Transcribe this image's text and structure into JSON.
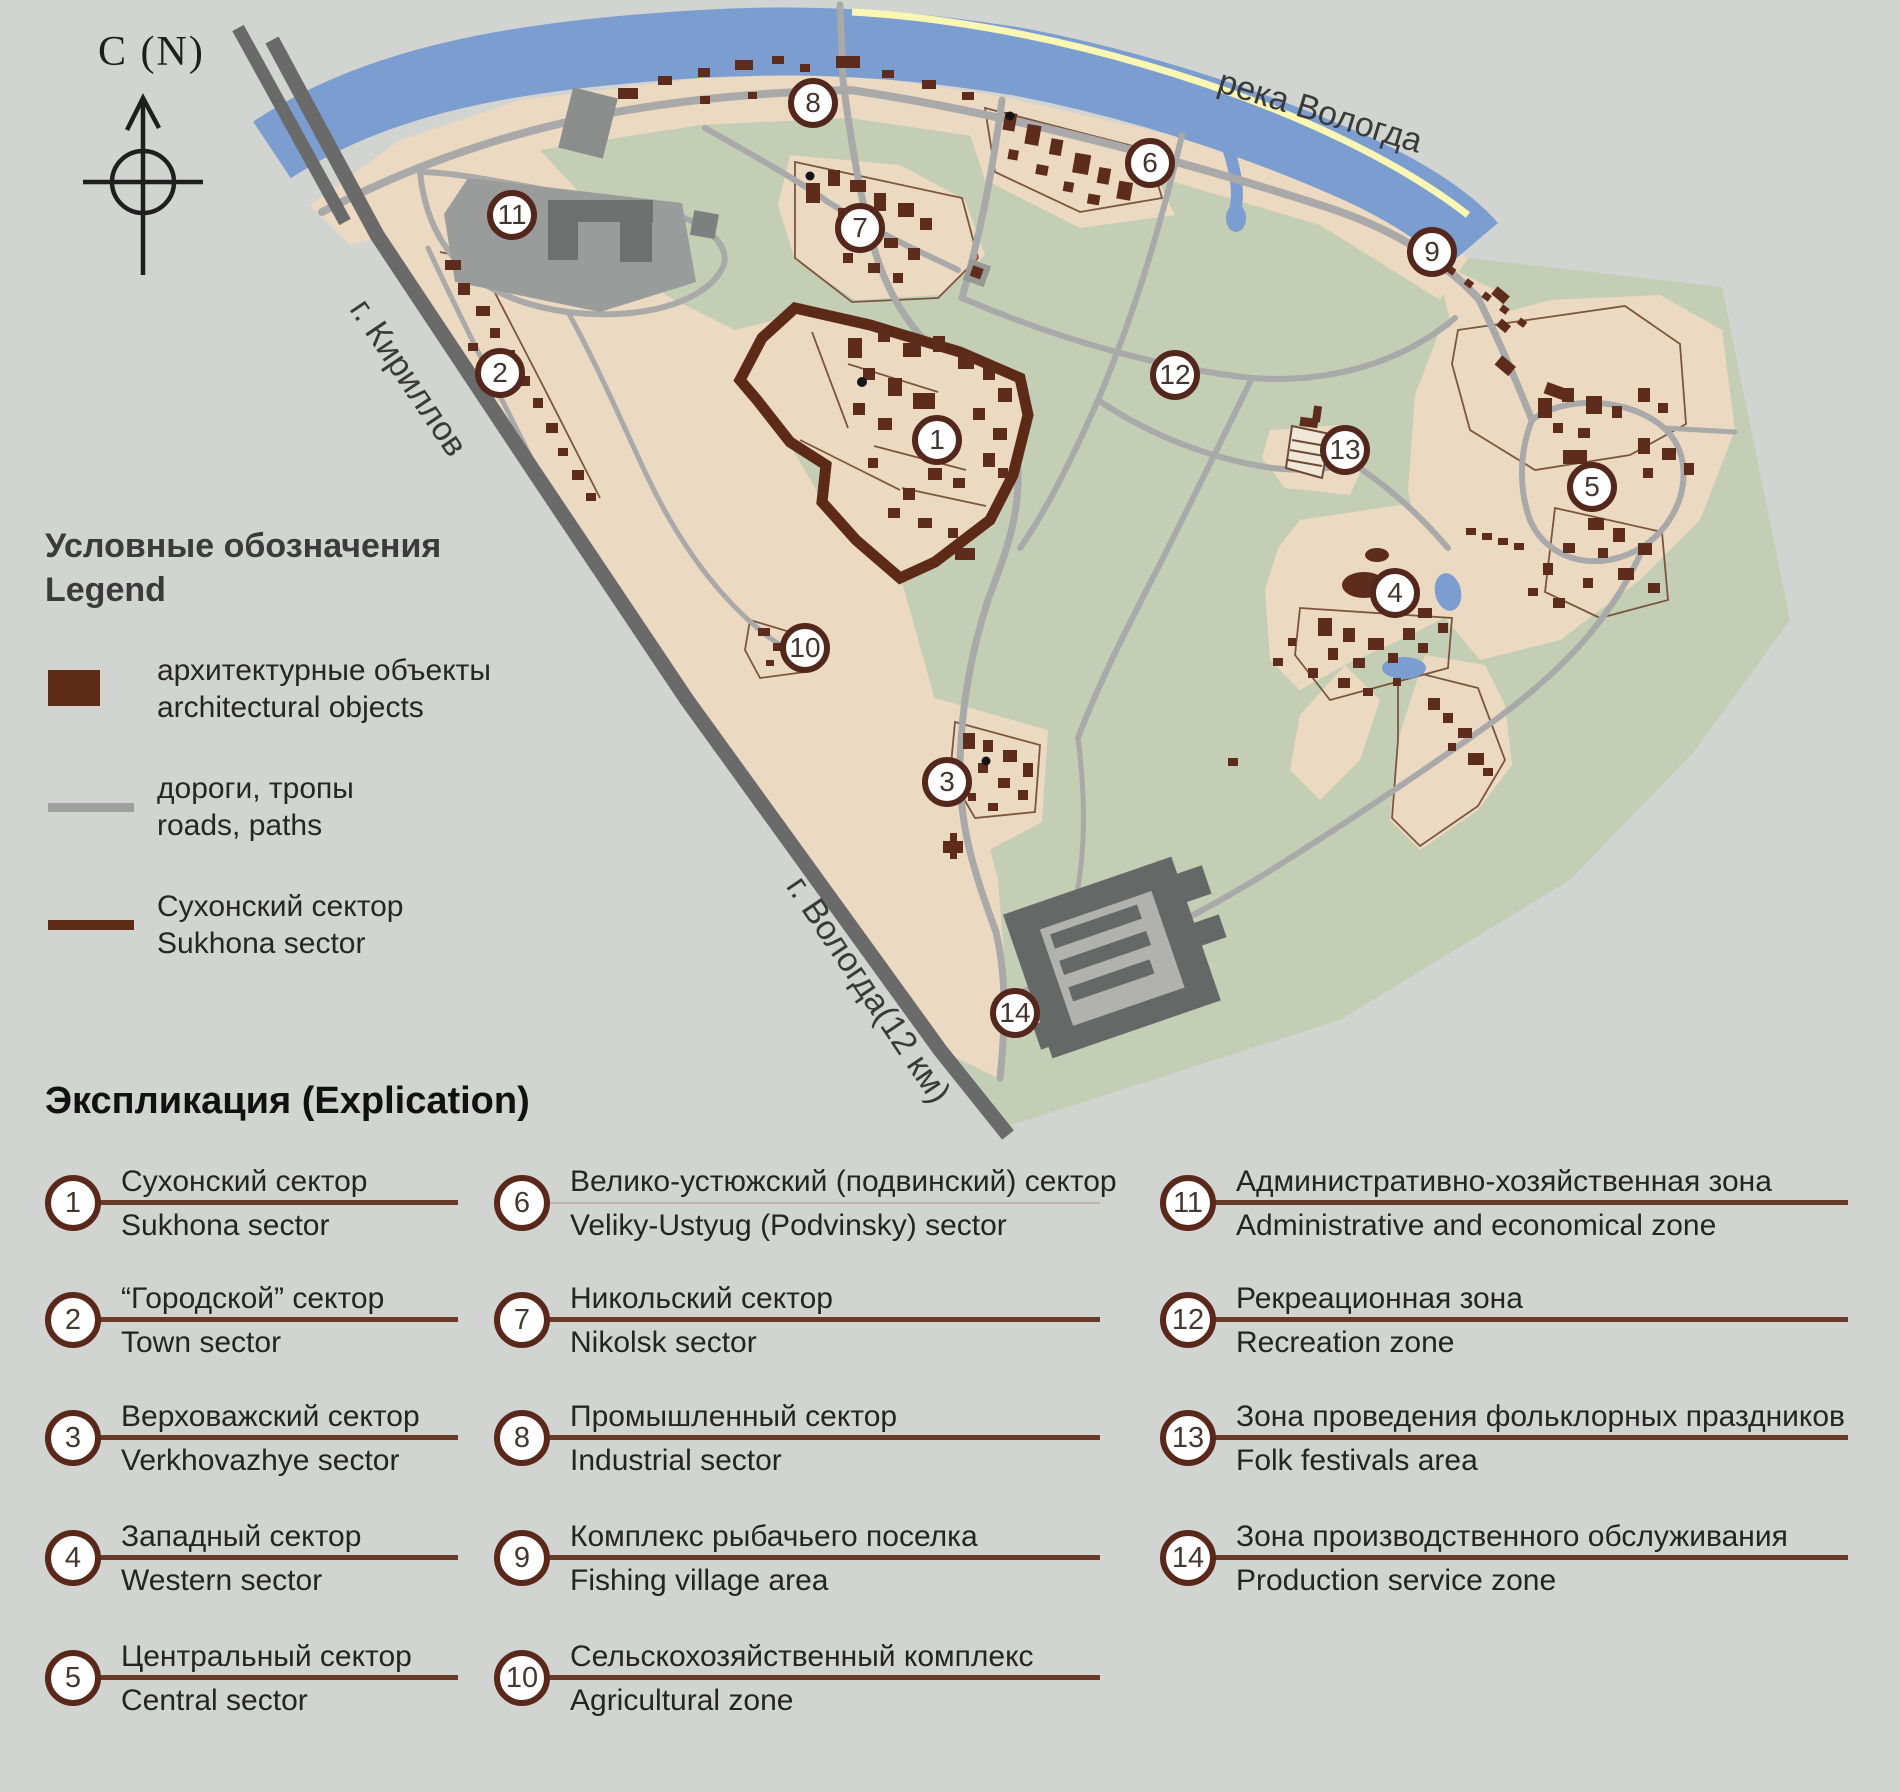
{
  "compass": {
    "label": "С (N)"
  },
  "map": {
    "river_label": "река Вологда",
    "road_labels": {
      "kirillov": "г. Кириллов",
      "vologda": "г. Вологда(12 км)"
    },
    "markers": [
      {
        "n": "1",
        "x": 937,
        "y": 440
      },
      {
        "n": "2",
        "x": 500,
        "y": 373
      },
      {
        "n": "3",
        "x": 947,
        "y": 782
      },
      {
        "n": "4",
        "x": 1395,
        "y": 593
      },
      {
        "n": "5",
        "x": 1592,
        "y": 487
      },
      {
        "n": "6",
        "x": 1150,
        "y": 163
      },
      {
        "n": "7",
        "x": 860,
        "y": 228
      },
      {
        "n": "8",
        "x": 813,
        "y": 103
      },
      {
        "n": "9",
        "x": 1432,
        "y": 252
      },
      {
        "n": "10",
        "x": 805,
        "y": 648
      },
      {
        "n": "11",
        "x": 512,
        "y": 215
      },
      {
        "n": "12",
        "x": 1175,
        "y": 375
      },
      {
        "n": "13",
        "x": 1345,
        "y": 450
      },
      {
        "n": "14",
        "x": 1015,
        "y": 1013
      }
    ]
  },
  "legend": {
    "title_ru": "Условные обозначения",
    "title_en": "Legend",
    "items": [
      {
        "swatch": "architectural-objects",
        "ru": "архитектурные объекты",
        "en": "architectural objects"
      },
      {
        "swatch": "roads-paths",
        "ru": "дороги, тропы",
        "en": "roads, paths"
      },
      {
        "swatch": "sukhona-sector",
        "ru": "Сухонский сектор",
        "en": "Sukhona sector"
      }
    ]
  },
  "explication": {
    "title": "Экспликация (Explication)",
    "items": [
      {
        "n": "1",
        "ru": "Сухонский сектор",
        "en": "Sukhona sector",
        "col": 1,
        "row": 1
      },
      {
        "n": "2",
        "ru": "“Городской” сектор",
        "en": "Town sector",
        "col": 1,
        "row": 2
      },
      {
        "n": "3",
        "ru": "Верховажский сектор",
        "en": "Verkhovazhye sector",
        "col": 1,
        "row": 3
      },
      {
        "n": "4",
        "ru": "Западный сектор",
        "en": "Western sector",
        "col": 1,
        "row": 4
      },
      {
        "n": "5",
        "ru": "Центральный сектор",
        "en": "Central sector",
        "col": 1,
        "row": 5
      },
      {
        "n": "6",
        "ru": "Велико-устюжский (подвинский) сектор",
        "en": "Veliky-Ustyug (Podvinsky) sector",
        "col": 2,
        "row": 1,
        "line": "thin"
      },
      {
        "n": "7",
        "ru": "Никольский сектор",
        "en": "Nikolsk sector",
        "col": 2,
        "row": 2
      },
      {
        "n": "8",
        "ru": "Промышленный сектор",
        "en": "Industrial sector",
        "col": 2,
        "row": 3
      },
      {
        "n": "9",
        "ru": "Комплекс рыбачьего поселка",
        "en": "Fishing village area",
        "col": 2,
        "row": 4
      },
      {
        "n": "10",
        "ru": "Сельскохозяйственный комплекс",
        "en": "Agricultural zone",
        "col": 2,
        "row": 5
      },
      {
        "n": "11",
        "ru": "Административно-хозяйственная зона",
        "en": "Administrative and economical zone",
        "col": 3,
        "row": 1
      },
      {
        "n": "12",
        "ru": "Рекреационная зона",
        "en": "Recreation zone",
        "col": 3,
        "row": 2
      },
      {
        "n": "13",
        "ru": "Зона проведения фольклорных праздников",
        "en": "Folk festivals area",
        "col": 3,
        "row": 3
      },
      {
        "n": "14",
        "ru": "Зона производственного обслуживания",
        "en": "Production service zone",
        "col": 3,
        "row": 4
      }
    ]
  },
  "colors": {
    "background": "#d2d4d1",
    "river": "#7b9dd0",
    "shore_line": "#faf7b4",
    "land_green": "#c3ceb4",
    "field_beige": "#ecd9c2",
    "road": "#a9a9a9",
    "highway": "#6a6a6a",
    "building": "#5e2c1c",
    "sector_outline": "#5c2a16",
    "marker_ring": "#53271b",
    "explication_line": "#6a3a28"
  }
}
